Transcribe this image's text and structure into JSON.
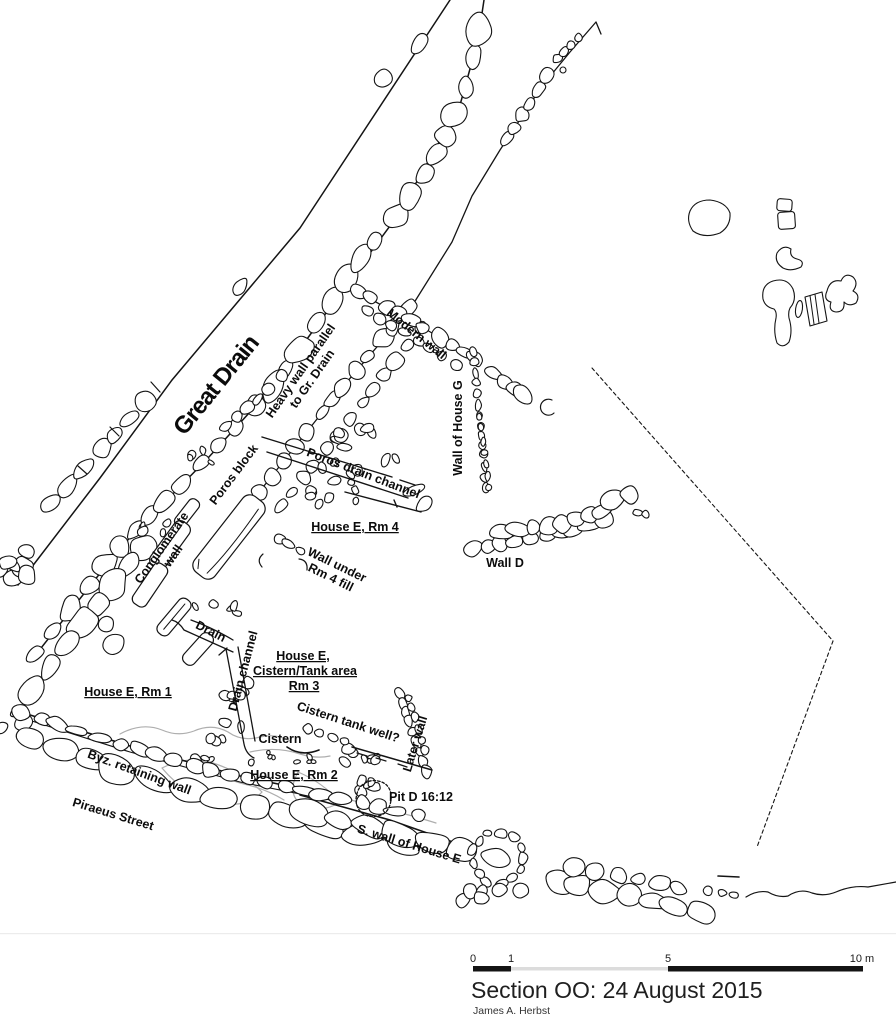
{
  "map": {
    "labels": {
      "great_drain": "Great Drain",
      "heavy_wall_1": "Heavy wall parallel",
      "heavy_wall_2": "to Gr. Drain",
      "modern_wall": "Modern wall",
      "wall_house_g": "Wall of House G",
      "poros_drain_channel": "Poros drain channel",
      "poros_block": "Poros block",
      "conglomerate_1": "Conglomerate",
      "conglomerate_2": "wall",
      "house_e_rm4": "House E, Rm 4",
      "wall_under_1": "Wall under",
      "wall_under_2": "Rm 4 fill",
      "wall_d": "Wall D",
      "drain": "Drain",
      "drain_channel": "Drain channel",
      "rm3_line1": "House E,",
      "rm3_line2": "Cistern/Tank area",
      "rm3_line3": "Rm 3",
      "house_e_rm1": "House E, Rm 1",
      "cistern_tank_well": "Cistern tank well?",
      "later_wall": "Later wall",
      "cistern": "Cistern",
      "house_e_rm2": "House E, Rm 2",
      "pit": "Pit D 16:12",
      "s_wall": "S. wall of House E",
      "byz_wall": "Byz. retaining wall",
      "piraeus": "Piraeus Street"
    },
    "style": {
      "ink": "#141414",
      "disturbance_grey": "#aeaeae"
    }
  },
  "footer": {
    "scale_ticks": [
      "0",
      "1",
      "5",
      "10 m"
    ],
    "title": "Section OO: 24 August 2015",
    "author": "James A. Herbst"
  }
}
